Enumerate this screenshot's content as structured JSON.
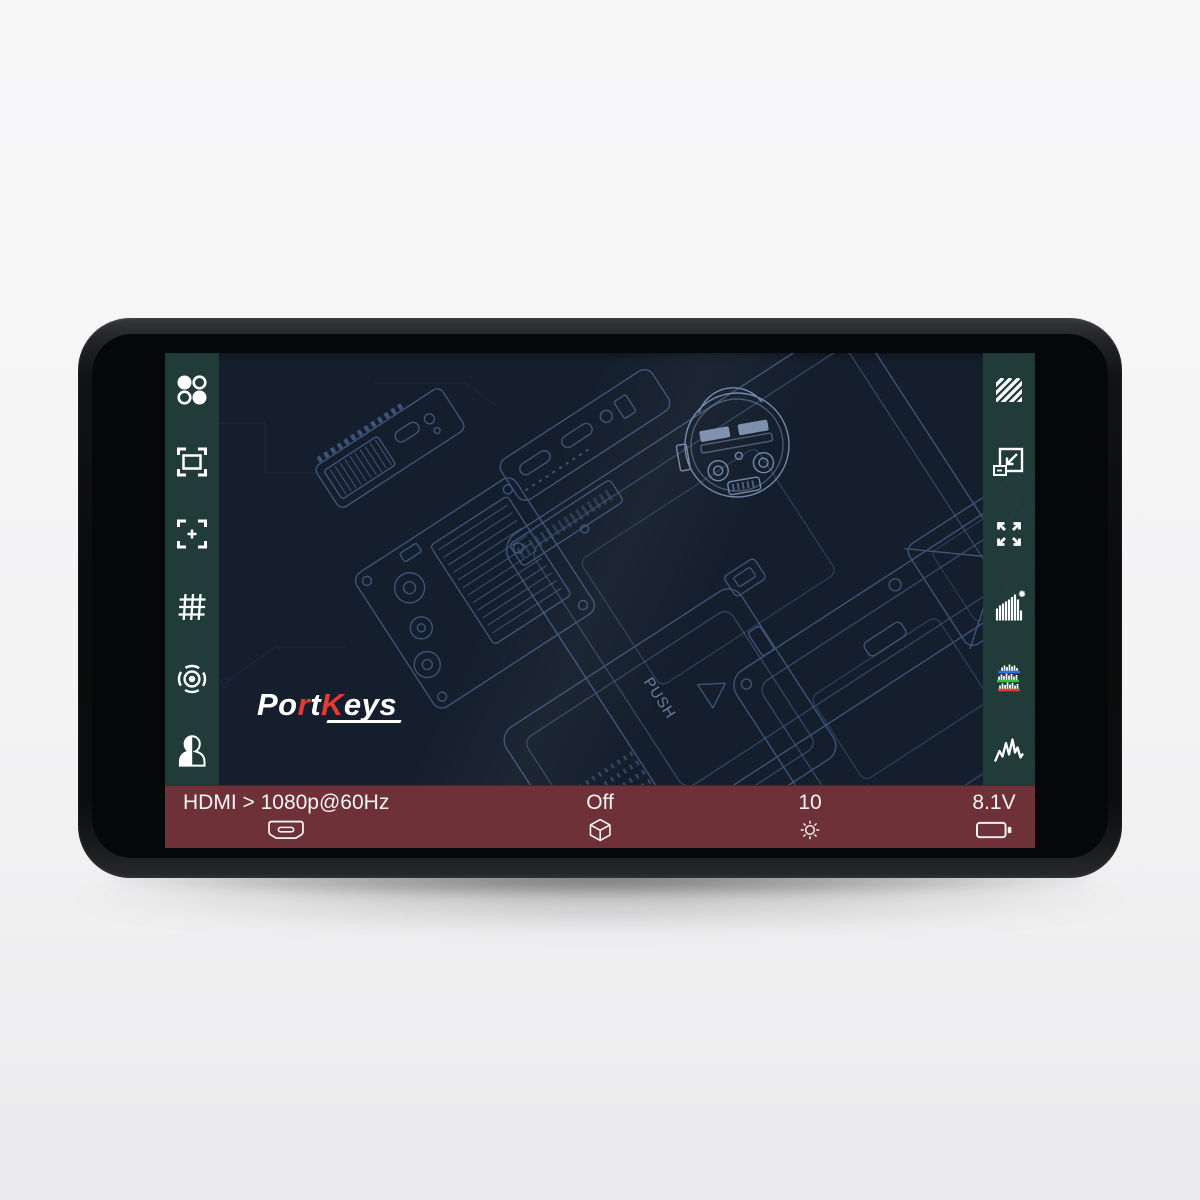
{
  "brand": {
    "logo_segments": [
      {
        "text": "Po",
        "color": "#ffffff"
      },
      {
        "text": "r",
        "color": "#e23b30"
      },
      {
        "text": "t",
        "color": "#ffffff"
      },
      {
        "text": "K",
        "color": "#e23b30"
      },
      {
        "text": "eys",
        "color": "#ffffff"
      }
    ]
  },
  "left_toolbar": {
    "items": [
      {
        "id": "menu",
        "icon": "four-dots-icon"
      },
      {
        "id": "safe-frame",
        "icon": "safe-frame-icon"
      },
      {
        "id": "center-marker",
        "icon": "center-marker-icon"
      },
      {
        "id": "grid",
        "icon": "grid-icon"
      },
      {
        "id": "target",
        "icon": "target-icon"
      },
      {
        "id": "portrait",
        "icon": "portrait-icon"
      }
    ]
  },
  "right_toolbar": {
    "items": [
      {
        "id": "zebra",
        "icon": "zebra-stripes-icon"
      },
      {
        "id": "pixel-zoom",
        "icon": "scale-down-icon"
      },
      {
        "id": "fullscreen",
        "icon": "expand-arrows-icon"
      },
      {
        "id": "histogram",
        "icon": "histogram-icon"
      },
      {
        "id": "rgb-parade",
        "icon": "rgb-parade-icon"
      },
      {
        "id": "waveform",
        "icon": "waveform-icon"
      }
    ]
  },
  "status_bar": {
    "input_label": "HDMI > 1080p@60Hz",
    "lut_value": "Off",
    "brightness_value": "10",
    "battery_voltage": "8.1V"
  },
  "background_art": {
    "push_label": "PUSH"
  },
  "colors": {
    "status_bar_bg": "#6e3137",
    "sidebar_bg": "#213c39",
    "screen_bg": "#151e2c",
    "blueprint_line": "#47628c",
    "blueprint_bright": "#8ba3c9",
    "logo_red": "#e23b30",
    "icon_white": "#ffffff",
    "parade_blue": "#2e6bf0",
    "parade_green": "#2cc14b",
    "parade_red": "#e83a2d"
  }
}
